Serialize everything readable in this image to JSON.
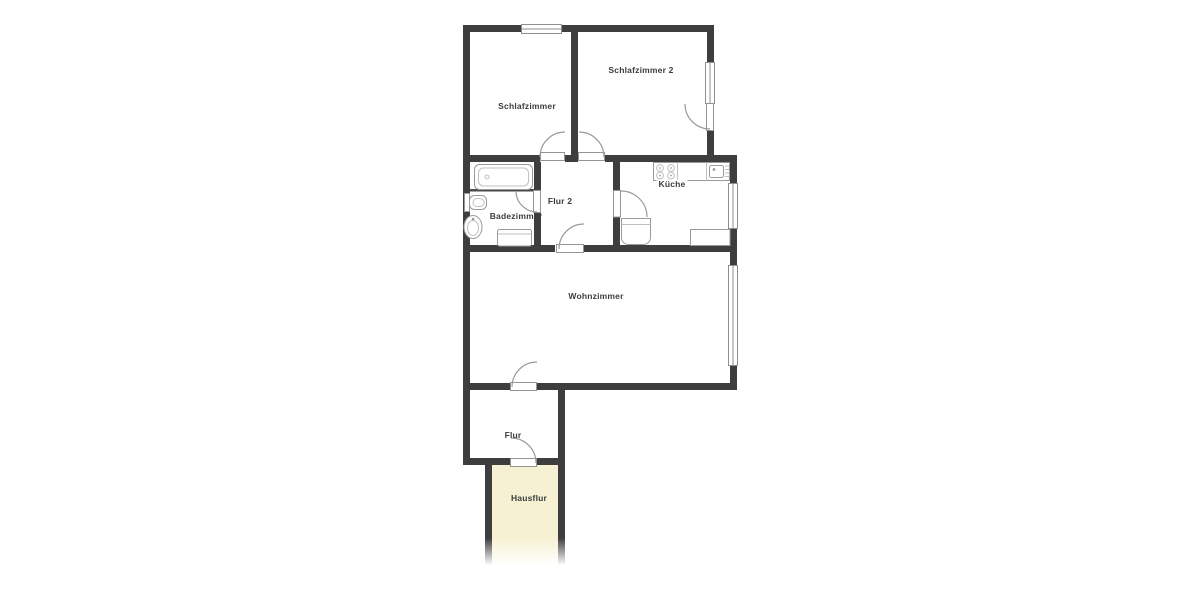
{
  "plan": {
    "rooms": [
      {
        "name": "Schlafzimmer"
      },
      {
        "name": "Schlafzimmer 2"
      },
      {
        "name": "Badezimmer"
      },
      {
        "name": "Flur 2"
      },
      {
        "name": "Küche"
      },
      {
        "name": "Wohnzimmer"
      },
      {
        "name": "Flur"
      },
      {
        "name": "Hausflur"
      }
    ],
    "fixtures": [
      "bathtub",
      "toilet",
      "washbasin",
      "washing-machine",
      "stove",
      "kitchen-sink",
      "kitchen-counter",
      "refrigerator"
    ],
    "colors": {
      "wall": "#3e3e3e",
      "fixture_outline": "#9a9a9a",
      "label_text": "#3c3c3c",
      "hausflur_fill": "#f6f1d3",
      "background": "#ffffff"
    }
  }
}
